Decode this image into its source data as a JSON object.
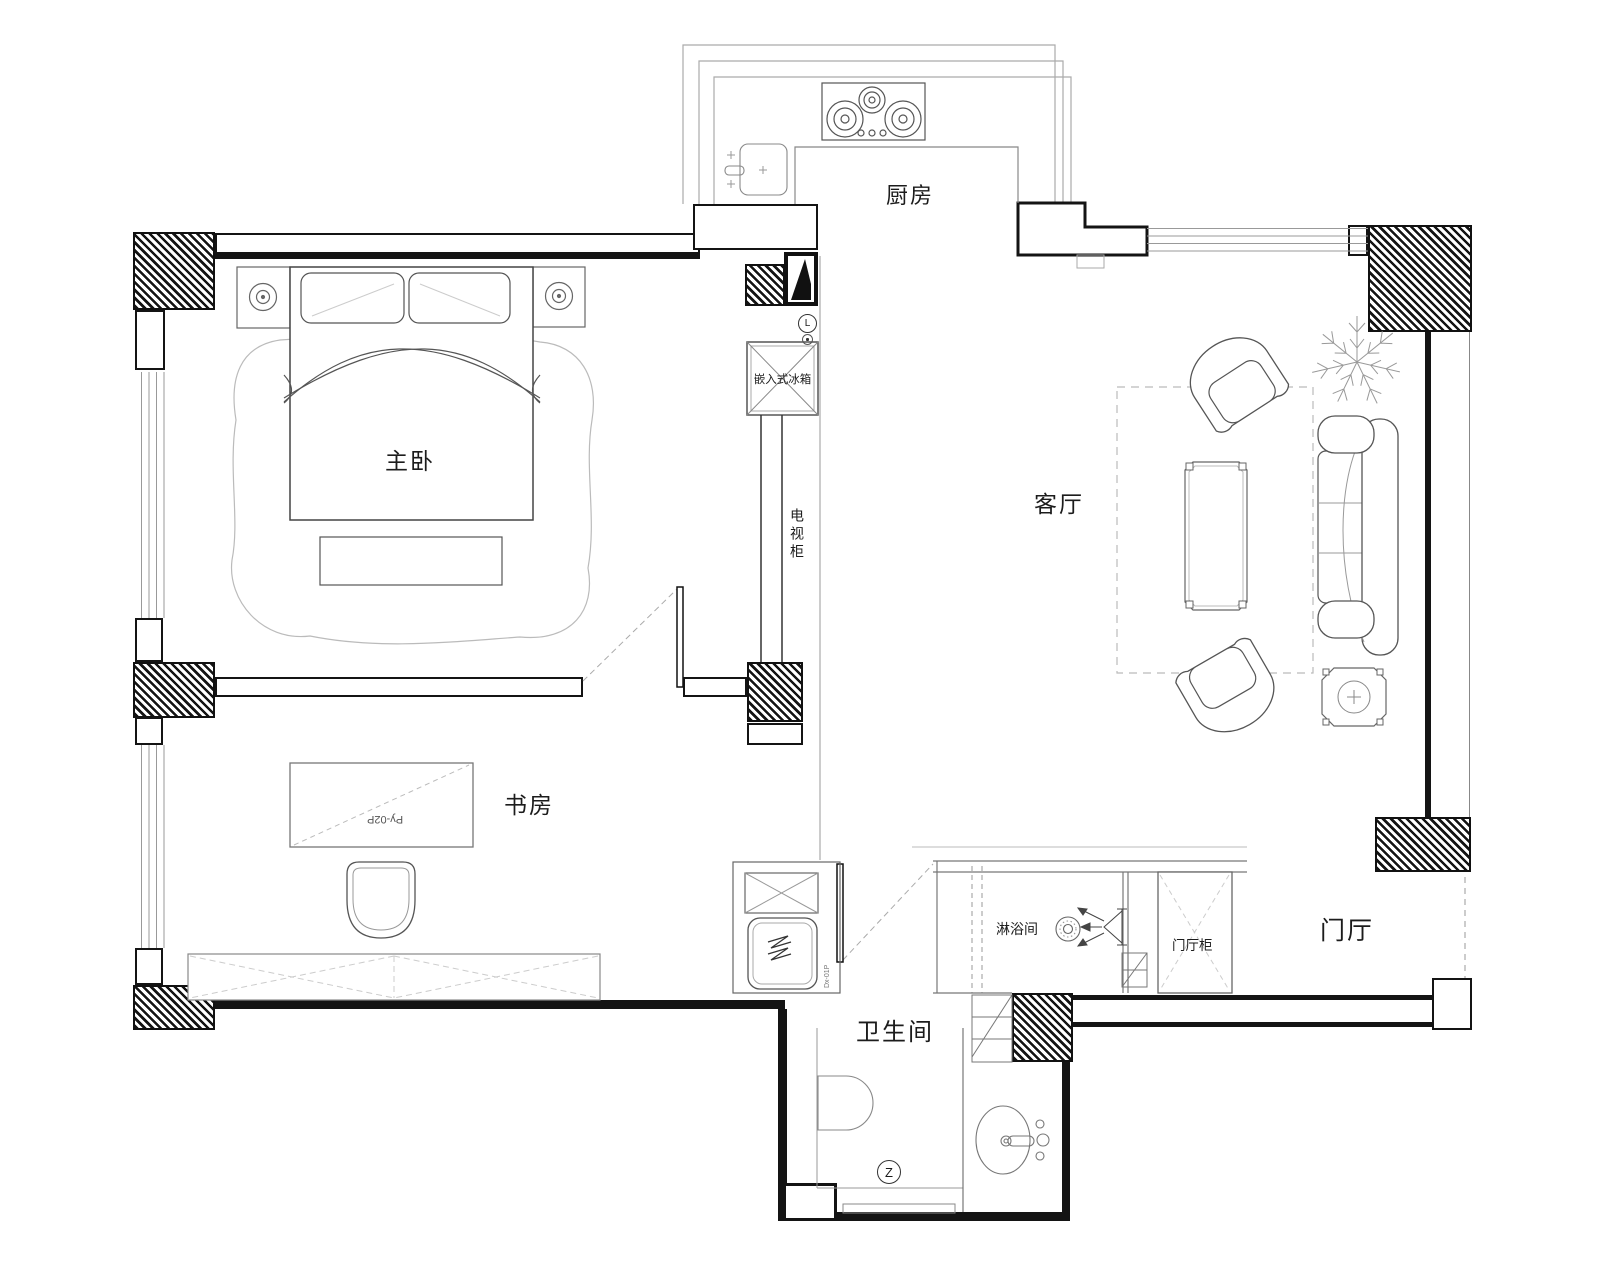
{
  "plan_title": "apartment-floor-plan",
  "rooms": {
    "kitchen": "厨房",
    "master_bedroom": "主卧",
    "living_room": "客厅",
    "study": "书房",
    "bathroom": "卫生间",
    "entry_hall": "门厅",
    "shower_room": "淋浴间"
  },
  "furniture": {
    "built_in_fridge": "嵌入式冰箱",
    "tv_cabinet": "电视柜",
    "entry_cabinet": "门厅柜",
    "desk_code": "Py-02P",
    "door_code": "Dx-01P"
  },
  "symbols": {
    "switch_l": "L",
    "switch_z": "Z"
  },
  "colors": {
    "wall": "#141414",
    "line_medium": "#777777",
    "line_light": "#aaaaaa",
    "background": "#ffffff"
  }
}
